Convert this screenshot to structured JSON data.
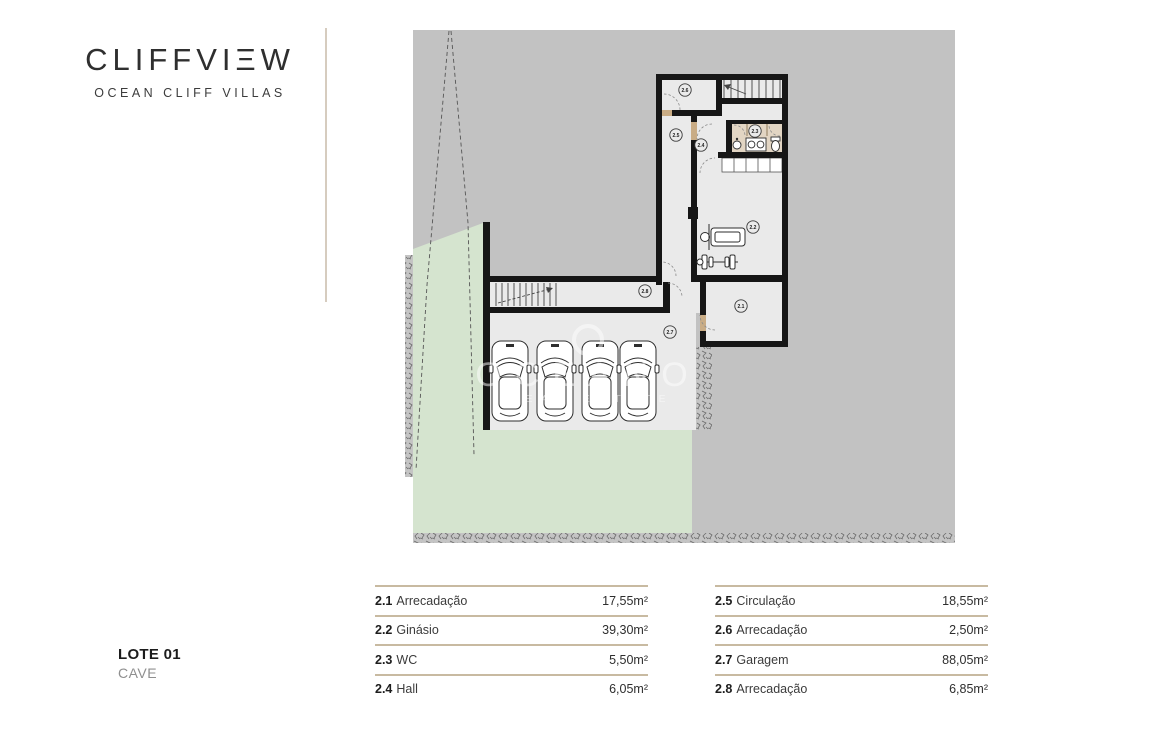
{
  "brand": {
    "name_pre": "CLIFFVI",
    "stylized_e": "Ξ",
    "name_post": "W",
    "subtitle": "OCEAN CLIFF VILLAS"
  },
  "lot": {
    "title": "LOTE 01",
    "level": "CAVE"
  },
  "watermark": {
    "line1": "OCEANO",
    "line2": "REAL ESTATE"
  },
  "plan": {
    "labels": [
      {
        "num": "2.1",
        "x": 741,
        "y": 306
      },
      {
        "num": "2.2",
        "x": 753,
        "y": 227
      },
      {
        "num": "2.3",
        "x": 755,
        "y": 131
      },
      {
        "num": "2.4",
        "x": 701,
        "y": 145
      },
      {
        "num": "2.5",
        "x": 676,
        "y": 135
      },
      {
        "num": "2.6",
        "x": 685,
        "y": 90
      },
      {
        "num": "2.7",
        "x": 670,
        "y": 332
      },
      {
        "num": "2.8",
        "x": 645,
        "y": 291
      }
    ],
    "colors": {
      "site": "#c2c2c2",
      "floor": "#eaeaea",
      "lawn": "#d5e4cf",
      "wall": "#161616",
      "wc_fill": "#e2d5c3",
      "threshold": "#c9ac85"
    }
  },
  "legend": {
    "left": [
      {
        "num": "2.1",
        "name": "Arrecadação",
        "area": "17,55m²"
      },
      {
        "num": "2.2",
        "name": "Ginásio",
        "area": "39,30m²"
      },
      {
        "num": "2.3",
        "name": "WC",
        "area": "5,50m²"
      },
      {
        "num": "2.4",
        "name": "Hall",
        "area": "6,05m²"
      }
    ],
    "right": [
      {
        "num": "2.5",
        "name": "Circulação",
        "area": "18,55m²"
      },
      {
        "num": "2.6",
        "name": "Arrecadação",
        "area": "2,50m²"
      },
      {
        "num": "2.7",
        "name": "Garagem",
        "area": "88,05m²"
      },
      {
        "num": "2.8",
        "name": "Arrecadação",
        "area": "6,85m²"
      }
    ]
  }
}
